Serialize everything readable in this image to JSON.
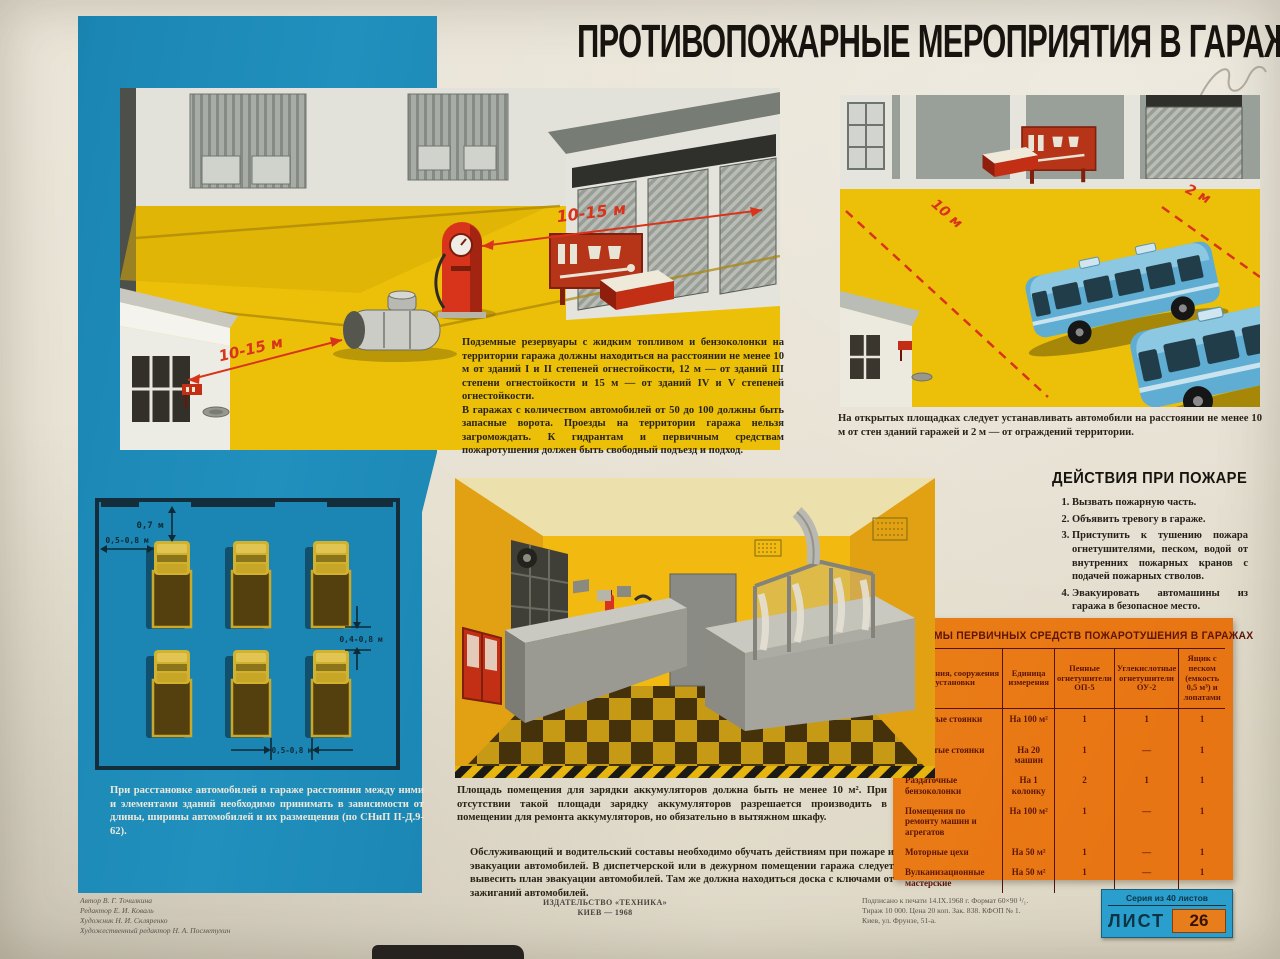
{
  "title": "ПРОТИВОПОЖАРНЫЕ МЕРОПРИЯТИЯ В ГАРАЖАХ",
  "colors": {
    "blue": "#1b86b4",
    "yellow": "#ecc008",
    "orange": "#e87d1b",
    "red": "#d8341c"
  },
  "site_panel": {
    "distance_pump": "10-15 м",
    "distance_tank": "10-15 м",
    "caption_p1": "Подземные резервуары с жидким топливом и бензоколонки на территории гаража должны находиться на расстоянии не менее 10 м от зданий I и II степеней огнестойкости, 12 м — от зданий III степени огнестойкости и 15 м — от зданий IV и V степеней огнестойкости.",
    "caption_p2": "В гаражах с количеством автомобилей от 50 до 100 должны быть запасные ворота. Проезды на территории гаража нельзя загромождать. К гидрантам и первичным средствам пожаротушения должен быть свободный подъезд и подход."
  },
  "open_lot_panel": {
    "distance_wall": "10 м",
    "distance_fence": "2 м",
    "caption": "На открытых площадках следует устанавливать автомобили на расстоянии не менее 10 м от стен зданий гаражей и 2 м — от ограждений территории."
  },
  "parking_diagram": {
    "dim_top": "0,7 м",
    "dim_left": "0,5-0,8 м",
    "dim_right": "0,4-0,8 м",
    "dim_bottom": "0,5-0,8 м",
    "caption": "При расстановке автомобилей в гараже расстояния между ними и элементами зданий необходимо принимать в зависимости от длины, ширины автомобилей и их размещения (по СНиП II-Д.9-62)."
  },
  "battery_room": {
    "caption_p1": "Площадь помещения для зарядки аккумуляторов должна быть не менее 10 м². При отсутствии такой площади зарядку аккумуляторов разрешается производить в помещении для ремонта аккумуляторов, но обязательно в вытяжном шкафу.",
    "caption_p2": "Обслуживающий и водительский составы необходимо обучать действиям при пожаре и эвакуации автомобилей. В диспетчерской или в дежурном помещении гаража следует вывесить план эвакуации автомобилей. Там же должна находиться доска с ключами от зажиганий автомобилей."
  },
  "fire_actions": {
    "heading": "ДЕЙСТВИЯ ПРИ ПОЖАРЕ",
    "items": [
      "Вызвать пожарную часть.",
      "Объявить тревогу в гараже.",
      "Приступить к тушению пожара огнетушителями, песком, водой от внутренних пожарных кранов с подачей пожарных стволов.",
      "Эвакуировать автомашины из гаража в безопасное место."
    ]
  },
  "norms_table": {
    "title": "НОРМЫ ПЕРВИЧНЫХ СРЕДСТВ ПОЖАРОТУШЕНИЯ В ГАРАЖАХ",
    "columns": [
      "Помещения, сооружения и установки",
      "Единица измерения",
      "Пенные огнетушители ОП-5",
      "Углекислотные огнетушители ОУ-2",
      "Ящик с песком (емкость 0,5 м³) и лопатами"
    ],
    "rows": [
      [
        "Закрытые стоянки машин",
        "На 100 м²",
        "1",
        "1",
        "1"
      ],
      [
        "Открытые стоянки машин",
        "На 20 машин",
        "1",
        "—",
        "1"
      ],
      [
        "Раздаточные бензоколонки",
        "На 1 колонку",
        "2",
        "1",
        "1"
      ],
      [
        "Помещения по ремонту машин и агрегатов",
        "На 100 м²",
        "1",
        "—",
        "1"
      ],
      [
        "Моторные цехи",
        "На 50 м²",
        "1",
        "—",
        "1"
      ],
      [
        "Вулканизационные мастерские",
        "На 50 м²",
        "1",
        "—",
        "1"
      ]
    ]
  },
  "footer": {
    "credits": [
      "Автор В. Г. Точилкина",
      "Редактор Е. И. Коваль",
      "Художник Н. И. Скляренко",
      "Художественный редактор Н. А. Посметухин"
    ],
    "publisher_line1": "ИЗДАТЕЛЬСТВО «ТЕХНИКА»",
    "publisher_line2": "КИЕВ — 1968",
    "print_info": [
      "Подписано к печати 14.IX.1968 г. Формат 60×90 ¹/₁.",
      "Тираж 10 000. Цена 20 коп. Зак. 838. КФОП № 1.",
      "Киев, ул. Фрунзе, 51-а."
    ],
    "series_label": "Серия из 40 листов",
    "sheet_label": "ЛИСТ",
    "sheet_number": "26"
  }
}
